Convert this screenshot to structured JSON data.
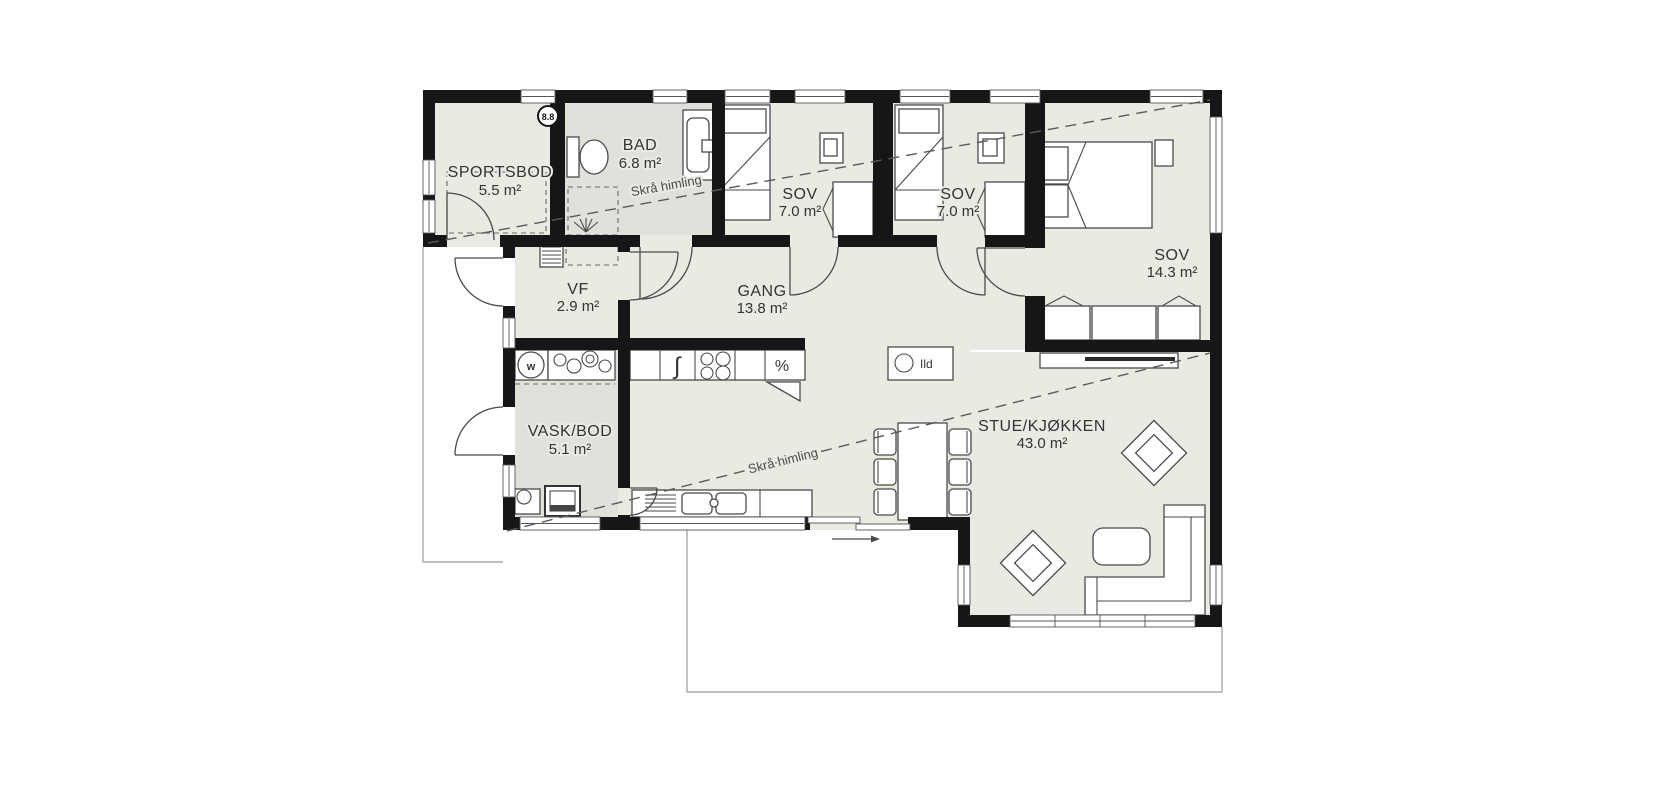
{
  "floorplan": {
    "badge": "8.8",
    "rooms": [
      {
        "name": "SPORTSBOD",
        "area": "5.5 m²"
      },
      {
        "name": "BAD",
        "area": "6.8 m²"
      },
      {
        "name": "SOV",
        "area": "7.0 m²"
      },
      {
        "name": "SOV",
        "area": "7.0 m²"
      },
      {
        "name": "SOV",
        "area": "14.3 m²"
      },
      {
        "name": "VF",
        "area": "2.9 m²"
      },
      {
        "name": "GANG",
        "area": "13.8 m²"
      },
      {
        "name": "VASK/BOD",
        "area": "5.1 m²"
      },
      {
        "name": "STUE/KJØKKEN",
        "area": "43.0 m²"
      }
    ],
    "annotations": {
      "sloped_ceiling_a": "Skrå himling",
      "sloped_ceiling_b": "Skrå himling",
      "fireplace_label": "Ild"
    },
    "symbols": {
      "washer": "w",
      "dishwasher": "∫",
      "cooler": "%"
    },
    "colors": {
      "wall": "#161616",
      "floor": "#eaeae3",
      "wet_floor": "#e1e1dc",
      "line": "#4a4a4a"
    }
  }
}
